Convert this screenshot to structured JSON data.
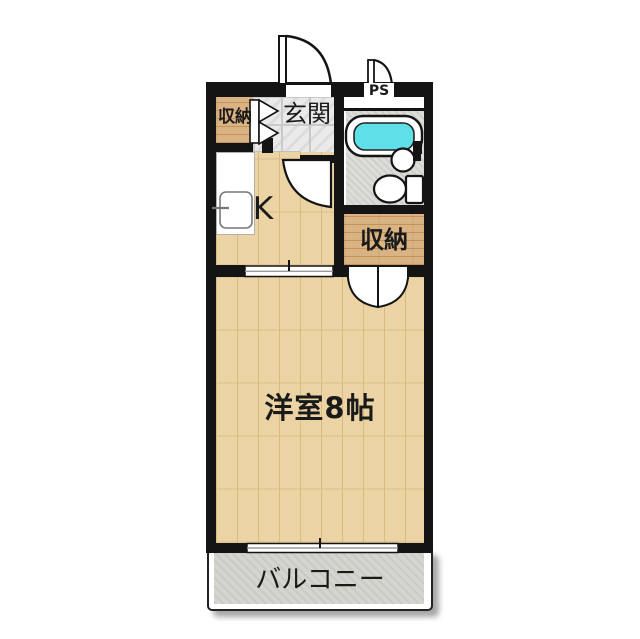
{
  "plan": {
    "type": "apartment-floor-plan",
    "labels": {
      "closet_top_left": "収納",
      "entrance": "玄関",
      "kitchen": "K",
      "pipe_space": "PS",
      "closet_right": "収納",
      "main_room": "洋室8帖",
      "balcony": "バルコニー"
    },
    "fixtures": {
      "bathtub": "bathtub",
      "wash_basin": "round wash basin",
      "toilet": "toilet with tank",
      "kitchen_sink": "kitchen sink with faucet",
      "entrance_door": "swing door",
      "ps_door": "small swing door",
      "bathroom_door": "swing door",
      "closet_bifold_door": "bi-fold door",
      "closet_double_door": "double swing door",
      "sliding_door": "sliding partition",
      "sliding_window": "sliding window to balcony"
    }
  },
  "colors": {
    "wall": "#141414",
    "floor-wood": "#ecd3a4",
    "floor-grain": "#d9ba83",
    "closet-wood": "#d9b382",
    "closet-grain": "#c2945b",
    "tile": "#eaeaea",
    "tile-line": "#c9c9c9",
    "bath-floor": "#dcdcd8",
    "tub-water": "#5fe0e9",
    "balcony": "#d5d5d0",
    "label": "#1a1a1a"
  }
}
